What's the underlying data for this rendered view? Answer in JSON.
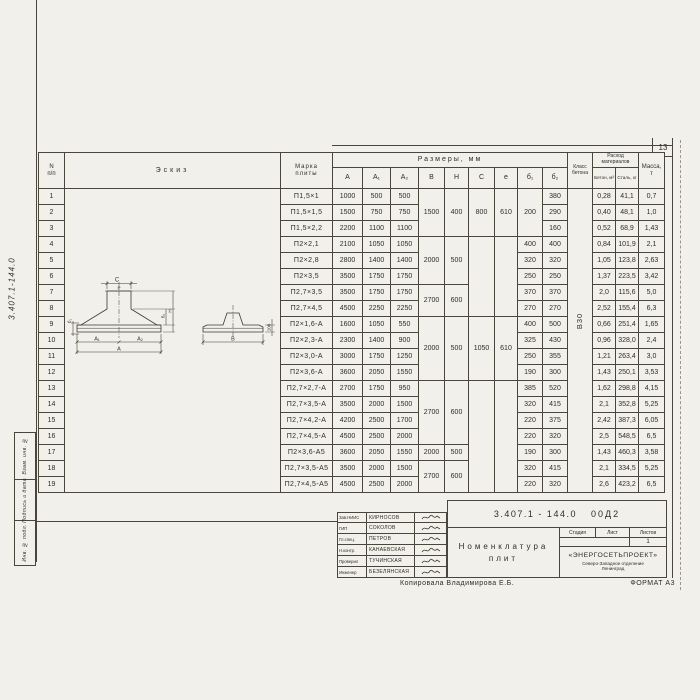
{
  "page": {
    "number": "13",
    "doc_code_vertical": "3.407.1-144.0",
    "copied_by": "Копировала Владимирова Е.Б.",
    "format_note": "ФОРМАТ А3"
  },
  "stamps": [
    "Взам. инв. №",
    "Подпись и дата",
    "Инв. № подл."
  ],
  "table": {
    "headers": {
      "num_top": "N",
      "num_bottom": "п/п",
      "sketch": "Эскиз",
      "mark_line1": "Марка",
      "mark_line2": "плиты",
      "dims_group": "Размеры, мм",
      "dims": [
        "А",
        "А₁",
        "А₂",
        "В",
        "Н",
        "С",
        "е",
        "б₁",
        "б₂"
      ],
      "class_line1": "Класс",
      "class_line2": "бетона",
      "consumption_line1": "Расход",
      "consumption_line2": "материалов",
      "concrete_sub": "Бетон, м³",
      "steel_sub": "Сталь, кг",
      "mass_line1": "Масса,",
      "mass_line2": "т",
      "concrete_class_value": "В30"
    },
    "rows": [
      {
        "n": "1",
        "mark": "П1,5×1",
        "c": [
          "1000",
          "500",
          "500",
          [
            "1500",
            3
          ],
          [
            "400",
            3
          ],
          [
            "800",
            3
          ],
          [
            "610",
            3
          ],
          [
            "200",
            3
          ],
          "380",
          "0,28",
          "41,1",
          "0,7"
        ]
      },
      {
        "n": "2",
        "mark": "П1,5×1,5",
        "c": [
          "1500",
          "750",
          "750",
          null,
          null,
          null,
          null,
          null,
          "290",
          "0,40",
          "48,1",
          "1,0"
        ]
      },
      {
        "n": "3",
        "mark": "П1,5×2,2",
        "c": [
          "2200",
          "1100",
          "1100",
          null,
          null,
          null,
          null,
          null,
          "160",
          "0,52",
          "68,9",
          "1,43"
        ]
      },
      {
        "n": "4",
        "mark": "П2×2,1",
        "c": [
          "2100",
          "1050",
          "1050",
          [
            "2000",
            3
          ],
          [
            "500",
            3
          ],
          [
            "",
            5
          ],
          [
            "",
            5
          ],
          "400",
          "400",
          "0,84",
          "101,9",
          "2,1"
        ]
      },
      {
        "n": "5",
        "mark": "П2×2,8",
        "c": [
          "2800",
          "1400",
          "1400",
          null,
          null,
          null,
          null,
          "320",
          "320",
          "1,05",
          "123,8",
          "2,63"
        ]
      },
      {
        "n": "6",
        "mark": "П2×3,5",
        "c": [
          "3500",
          "1750",
          "1750",
          null,
          null,
          null,
          null,
          "250",
          "250",
          "1,37",
          "223,5",
          "3,42"
        ]
      },
      {
        "n": "7",
        "mark": "П2,7×3,5",
        "c": [
          "3500",
          "1750",
          "1750",
          [
            "2700",
            2
          ],
          [
            "600",
            2
          ],
          null,
          null,
          "370",
          "370",
          "2,0",
          "115,6",
          "5,0"
        ]
      },
      {
        "n": "8",
        "mark": "П2,7×4,5",
        "c": [
          "4500",
          "2250",
          "2250",
          null,
          null,
          null,
          null,
          "270",
          "270",
          "2,52",
          "155,4",
          "6,3"
        ]
      },
      {
        "n": "9",
        "mark": "П2×1,6-А",
        "c": [
          "1600",
          "1050",
          "550",
          [
            "2000",
            4
          ],
          [
            "500",
            4
          ],
          [
            "1050",
            4
          ],
          [
            "610",
            4
          ],
          "400",
          "500",
          "0,66",
          "251,4",
          "1,65"
        ]
      },
      {
        "n": "10",
        "mark": "П2×2,3-А",
        "c": [
          "2300",
          "1400",
          "900",
          null,
          null,
          null,
          null,
          "325",
          "430",
          "0,96",
          "328,0",
          "2,4"
        ]
      },
      {
        "n": "11",
        "mark": "П2×3,0-А",
        "c": [
          "3000",
          "1750",
          "1250",
          null,
          null,
          null,
          null,
          "250",
          "355",
          "1,21",
          "263,4",
          "3,0"
        ]
      },
      {
        "n": "12",
        "mark": "П2×3,6-А",
        "c": [
          "3600",
          "2050",
          "1550",
          null,
          null,
          null,
          null,
          "190",
          "300",
          "1,43",
          "250,1",
          "3,53"
        ]
      },
      {
        "n": "13",
        "mark": "П2,7×2,7-А",
        "c": [
          "2700",
          "1750",
          "950",
          [
            "2700",
            4
          ],
          [
            "600",
            4
          ],
          [
            "",
            7
          ],
          [
            "",
            7
          ],
          "385",
          "520",
          "1,62",
          "298,8",
          "4,15"
        ]
      },
      {
        "n": "14",
        "mark": "П2,7×3,5-А",
        "c": [
          "3500",
          "2000",
          "1500",
          null,
          null,
          null,
          null,
          "320",
          "415",
          "2,1",
          "352,8",
          "5,25"
        ]
      },
      {
        "n": "15",
        "mark": "П2,7×4,2-А",
        "c": [
          "4200",
          "2500",
          "1700",
          null,
          null,
          null,
          null,
          "220",
          "375",
          "2,42",
          "387,3",
          "6,05"
        ]
      },
      {
        "n": "16",
        "mark": "П2,7×4,5-А",
        "c": [
          "4500",
          "2500",
          "2000",
          null,
          null,
          null,
          null,
          "220",
          "320",
          "2,5",
          "548,5",
          "6,5"
        ]
      },
      {
        "n": "17",
        "mark": "П2×3,6-А5",
        "c": [
          "3600",
          "2050",
          "1550",
          "2000",
          "500",
          null,
          null,
          "190",
          "300",
          "1,43",
          "460,3",
          "3,58"
        ]
      },
      {
        "n": "18",
        "mark": "П2,7×3,5-А5",
        "c": [
          "3500",
          "2000",
          "1500",
          [
            "2700",
            2
          ],
          [
            "600",
            2
          ],
          null,
          null,
          "320",
          "415",
          "2,1",
          "334,5",
          "5,25"
        ]
      },
      {
        "n": "19",
        "mark": "П2,7×4,5-А5",
        "c": [
          "4500",
          "2500",
          "2000",
          null,
          null,
          null,
          null,
          "220",
          "320",
          "2,6",
          "423,2",
          "6,5"
        ]
      }
    ]
  },
  "sketch": {
    "labels": {
      "c": "С",
      "e": "е",
      "b1": "б₁",
      "b2": "б₂",
      "h": "Н",
      "a1": "А₁",
      "a2": "А₂",
      "a": "А",
      "b": "В",
      "edge": "100"
    }
  },
  "title_block": {
    "doc_number": "3.407.1 - 144.0",
    "doc_suffix": "00Д2",
    "title_line1": "Номенклатура",
    "title_line2": "плит",
    "stage_label": "Стадия",
    "sheet_label": "Лист",
    "sheets_label": "Листов",
    "sheets_value": "1",
    "org_name": "«ЭНЕРГОСЕТЬПРОЕКТ»",
    "org_sub1": "Северо-Западное отделение",
    "org_sub2": "Ленинград",
    "signers": [
      {
        "role": "Зав.НИИС",
        "name": "КИРНОСОВ"
      },
      {
        "role": "ГИП",
        "name": "СОКОЛОВ"
      },
      {
        "role": "Гл.спец.",
        "name": "ПЕТРОВ"
      },
      {
        "role": "Н.контр.",
        "name": "КАНАЕВСКАЯ"
      },
      {
        "role": "Проверил",
        "name": "ТУЧИНСКАЯ"
      },
      {
        "role": "Инженер",
        "name": "БЕЗЕЛЯНСКАЯ"
      }
    ]
  }
}
